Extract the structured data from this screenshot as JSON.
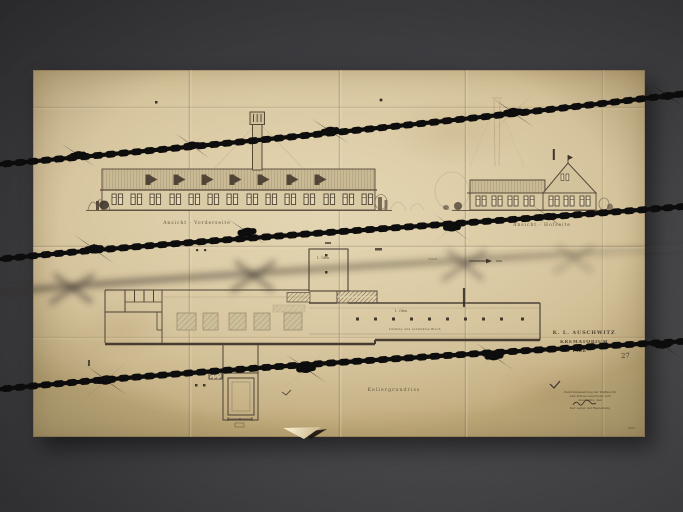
{
  "photo": {
    "subject": "aged architectural blueprint photographed behind barbed wire",
    "wire_strands_sharp": 3,
    "wire_strands_blurred": 1
  },
  "colors": {
    "background_dark": "#3d3d40",
    "paper": "#dccca6",
    "ink": "#4c4236",
    "wire": "#0c0b09"
  },
  "drawing": {
    "label_left_elevation": "Ansicht · Vorderseite",
    "label_right_elevation": "Ansicht · Hofseite",
    "label_plan": "Kellergrundriss",
    "label_shaft": "1. Öfen",
    "label_wing": "1. Ofen",
    "note_wing": "Lüftung und verzinktes Blech",
    "note_duct": "Zuluft",
    "title_block": {
      "line1": "K. L. AUSCHWITZ",
      "line2": "KREMATORIUM",
      "line3": "B. Plan",
      "sheet_number": "27"
    },
    "stamp": {
      "lines": [
        "Zentralbauleitung der Waffen-SS",
        "und Polizei Auschwitz O/S",
        "Auschwitz, den",
        "Der Leiter der Bauleitung"
      ]
    },
    "corner_mark": "4627"
  }
}
